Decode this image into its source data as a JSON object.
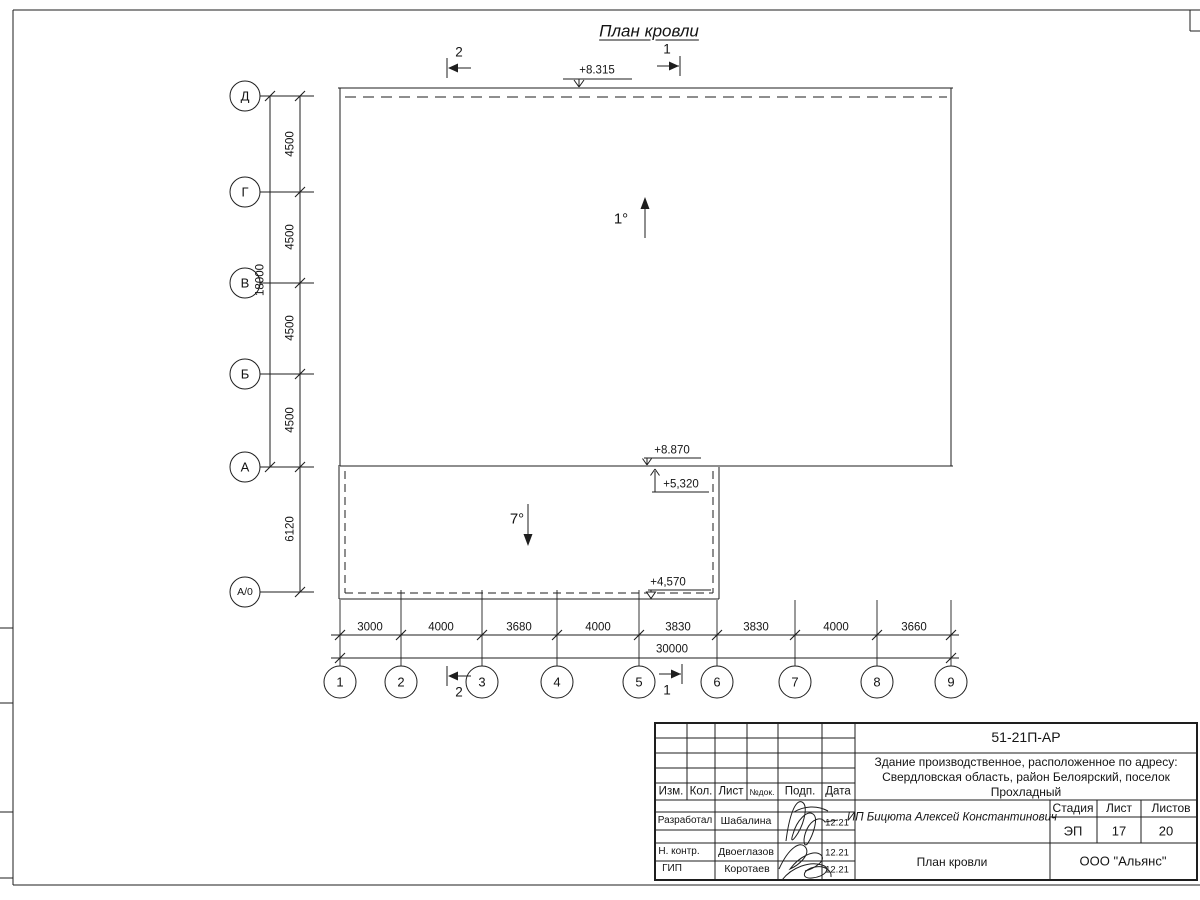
{
  "page": {
    "title": "План кровли"
  },
  "plan": {
    "row_axes": [
      "Д",
      "Г",
      "В",
      "Б",
      "А",
      "А/0"
    ],
    "col_axes": [
      "1",
      "2",
      "3",
      "4",
      "5",
      "6",
      "7",
      "8",
      "9"
    ],
    "row_dims": [
      "4500",
      "4500",
      "4500",
      "4500",
      "6120"
    ],
    "row_total": "18000",
    "col_dims": [
      "3000",
      "4000",
      "3680",
      "4000",
      "3830",
      "3830",
      "4000",
      "3660"
    ],
    "col_total": "30000",
    "elev_top": "+8.315",
    "elev_roof": "+8.870",
    "elev_canopy_top": "+5,320",
    "elev_canopy_low": "+4,570",
    "slope_main": "1°",
    "slope_canopy": "7°",
    "section_1": "1",
    "section_2": "2"
  },
  "titleblock": {
    "doc_number": "51-21П-АР",
    "object_lines": [
      "Здание производственное, расположенное по адресу:",
      "Свердловская область, район Белоярский, поселок",
      "Прохладный"
    ],
    "change_header": {
      "izm": "Изм.",
      "kol": "Кол.",
      "list": "Лист",
      "ndok": "№док.",
      "podp": "Подп.",
      "data": "Дата"
    },
    "sign_rows": [
      {
        "role": "Разработал",
        "name": "Шабалина",
        "date": "12.21"
      },
      {
        "role": "Н. контр.",
        "name": "Двоеглазов",
        "date": "12.21"
      },
      {
        "role": "ГИП",
        "name": "Коротаев",
        "date": "12.21"
      }
    ],
    "client": "ИП Бицюта Алексей Константинович",
    "stamp_header": {
      "stage": "Стадия",
      "sheet": "Лист",
      "sheets": "Листов"
    },
    "stamp": {
      "stage": "ЭП",
      "sheet": "17",
      "sheets": "20"
    },
    "sheet_title": "План кровли",
    "company": "ООО \"Альянс\""
  },
  "colors": {
    "line": "#1e1e1e",
    "bg": "#ffffff"
  }
}
